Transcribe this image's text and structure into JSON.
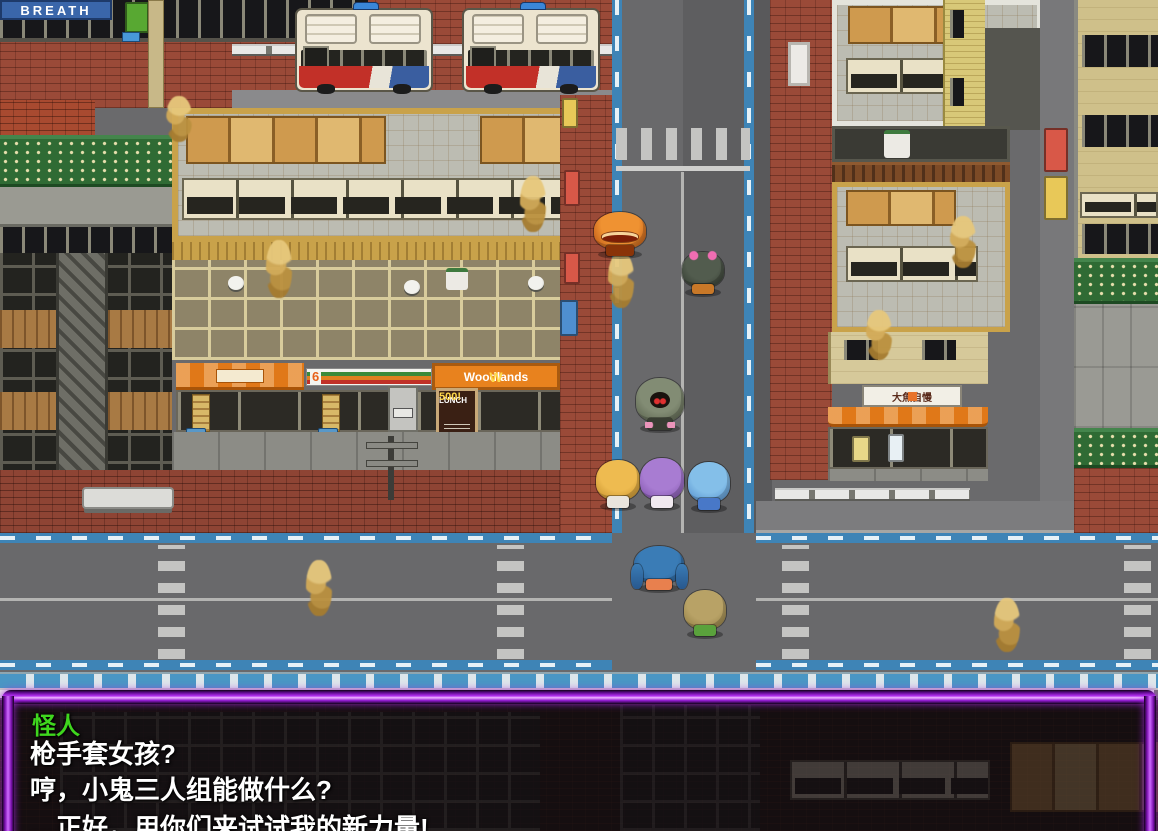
{
  "meta": {
    "scene": "rpg-city-street",
    "width": 1158,
    "height": 831
  },
  "dialogue": {
    "speaker": "怪人",
    "speaker_color": "#3fd61e",
    "text_color": "#ffffff",
    "frame_color": "#b22ef0",
    "lines": [
      "枪手套女孩?",
      "哼，小鬼三人组能做什么?",
      "…正好，用你们来试试我的新力量!"
    ]
  },
  "signs": {
    "breath_banner": "BREATH",
    "store_number": "6",
    "woodlands_logo": "W",
    "woodlands_name": "Woodlands",
    "lunch_title": "LUNCH",
    "lunch_price": "500!",
    "fish_shop": "大魚自慢"
  },
  "sprites": {
    "characters": [
      {
        "id": "orange-monster",
        "x": 594,
        "y": 212,
        "w": 52,
        "h": 44,
        "hair": "#ef9232",
        "hair2": "#b34c10",
        "body": "#8a3408",
        "type": "monster"
      },
      {
        "id": "bow-girl",
        "x": 682,
        "y": 252,
        "w": 42,
        "h": 42,
        "hair": "#525c4e",
        "hair2": "#30382e",
        "body": "#c87828",
        "type": "bowgirl"
      },
      {
        "id": "hooded-figure",
        "x": 636,
        "y": 378,
        "w": 48,
        "h": 52,
        "hair": "#828c74",
        "hair2": "#545c48",
        "body": "#383d32",
        "type": "hooded"
      },
      {
        "id": "blonde-girl",
        "x": 596,
        "y": 460,
        "w": 44,
        "h": 48,
        "hair": "#eebb50",
        "hair2": "#c08a28",
        "body": "#e9e5dd",
        "type": "npc"
      },
      {
        "id": "purple-girl",
        "x": 640,
        "y": 458,
        "w": 44,
        "h": 50,
        "hair": "#a87cd2",
        "hair2": "#7b4ea6",
        "body": "#f0e9ef",
        "type": "npc"
      },
      {
        "id": "blue-girl",
        "x": 688,
        "y": 462,
        "w": 42,
        "h": 48,
        "hair": "#84bfe9",
        "hair2": "#4e88c8",
        "body": "#4878c8",
        "type": "npc"
      },
      {
        "id": "twintail-girl",
        "x": 634,
        "y": 546,
        "w": 50,
        "h": 44,
        "hair": "#3a7cb6",
        "hair2": "#28588e",
        "body": "#e8804e",
        "type": "twintail"
      },
      {
        "id": "brown-kid",
        "x": 684,
        "y": 590,
        "w": 42,
        "h": 46,
        "hair": "#b8a266",
        "hair2": "#8c783f",
        "body": "#5aa23c",
        "type": "npc"
      }
    ],
    "smoke": [
      {
        "x": 166,
        "y": 96,
        "h": 46
      },
      {
        "x": 266,
        "y": 240,
        "h": 58
      },
      {
        "x": 520,
        "y": 176,
        "h": 56
      },
      {
        "x": 608,
        "y": 252,
        "h": 56
      },
      {
        "x": 866,
        "y": 310,
        "h": 50
      },
      {
        "x": 950,
        "y": 216,
        "h": 52
      },
      {
        "x": 306,
        "y": 560,
        "h": 56
      },
      {
        "x": 994,
        "y": 598,
        "h": 54
      }
    ]
  },
  "palette": {
    "road": "#6a6a6c",
    "bike_lane": "#3e84b6",
    "brick": "#9a4a38",
    "roof": "#bcbcb2",
    "tan_wall": "#d6c99a",
    "awning": "#e07818",
    "lattice_green": "#2f6b34",
    "smoke_gold": "#d3ab58"
  }
}
